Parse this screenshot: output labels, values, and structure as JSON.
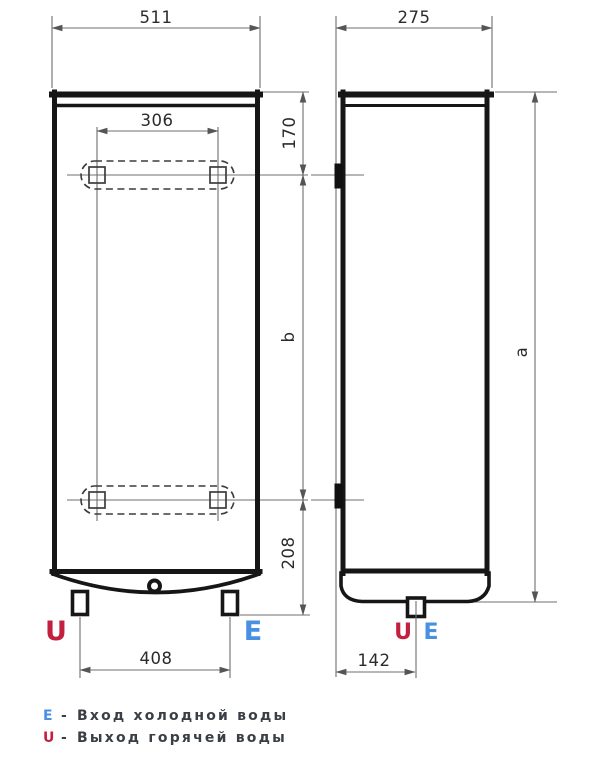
{
  "drawing": {
    "front_view": {
      "width": "511",
      "mount_width": "306",
      "mount_top_offset": "170",
      "mount_span": "b",
      "mount_bottom_offset": "208",
      "feet_span": "408",
      "outlet": "U",
      "inlet": "E"
    },
    "side_view": {
      "depth": "275",
      "height": "a",
      "pipe_offset": "142",
      "outlet": "U",
      "inlet": "E"
    },
    "legend": {
      "items": [
        {
          "symbol": "E",
          "dash": "-",
          "label": "Вход холодной воды"
        },
        {
          "symbol": "U",
          "dash": "-",
          "label": "Выход горячей воды"
        }
      ]
    },
    "colors": {
      "outline": "#161616",
      "dimension_lines": "#6f6f6f",
      "outlet_red": "#c2203f",
      "inlet_blue": "#4a90e2",
      "legend_text": "#3a3f46"
    }
  }
}
